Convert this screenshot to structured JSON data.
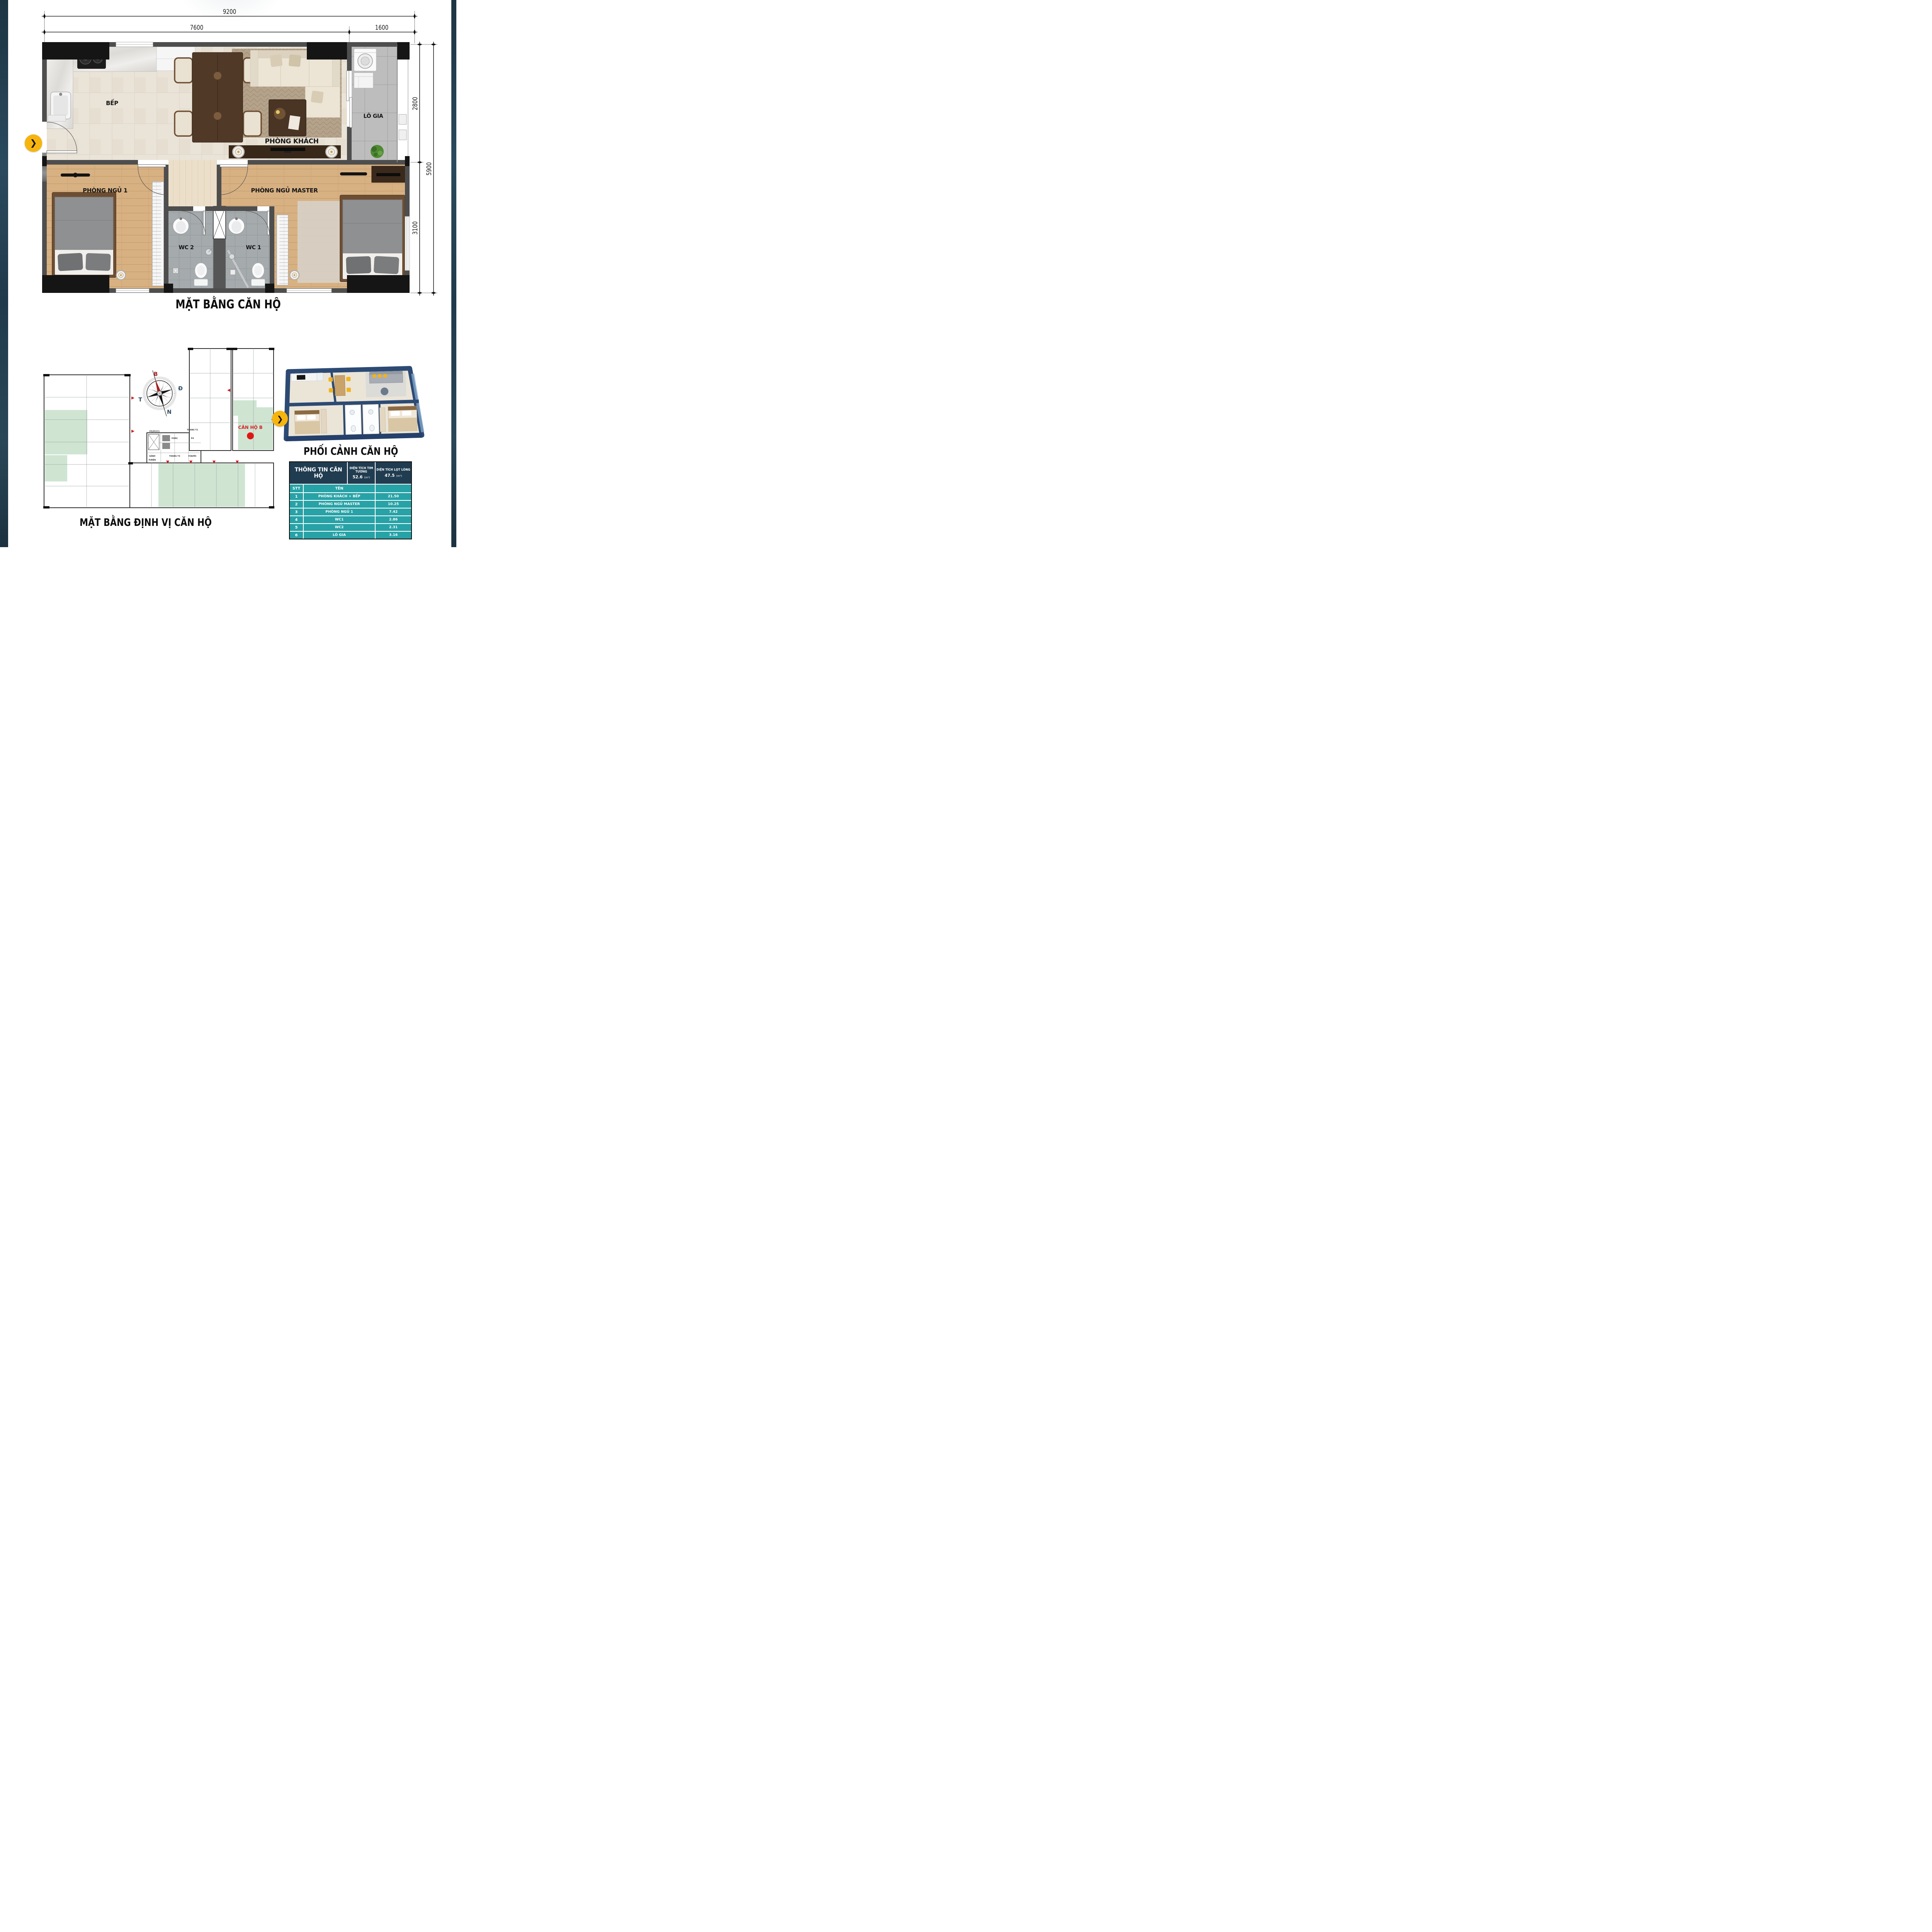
{
  "colors": {
    "accent_yellow": "#f6b40e",
    "table_header_bg": "#203c50",
    "table_row_bg": "#27a2a6",
    "highlight_green": "#cfe5d2",
    "red_marker": "#d81e1e",
    "wall_gray": "#4e4e4e",
    "band_navy": "#22394a"
  },
  "floor_plan": {
    "title": "MẶT BẰNG CĂN HỘ",
    "room_labels": {
      "kitchen": "BẾP",
      "living": "PHÒNG KHÁCH",
      "loggia": "LÔ GIA",
      "bedroom_1": "PHÒNG NGỦ 1",
      "bedroom_master": "PHÒNG NGỦ MASTER",
      "wc_1": "WC 1",
      "wc_2": "WC 2"
    },
    "dimensions": {
      "overall_width": "9200",
      "main_width": "7600",
      "loggia_width": "1600",
      "overall_depth": "5900",
      "living_depth": "2800",
      "bedroom_depth": "3100"
    }
  },
  "site_plan": {
    "title": "MẶT BẰNG ĐỊNH VỊ CĂN HỘ",
    "highlight_label": "CĂN HỘ B",
    "compass": {
      "north": "B",
      "east": "Đ",
      "south": "N",
      "west": "T"
    },
    "core_labels": [
      "THANG T2",
      "P5(PCCC)",
      "SẢNH",
      "P.RÁC",
      "P4",
      "P.ĐIỆN",
      "THANG T3",
      "P.NƯỚC"
    ]
  },
  "perspective": {
    "title": "PHỐI CẢNH CĂN HỘ"
  },
  "info_table": {
    "header": "THÔNG TIN CĂN HỘ",
    "area_columns": [
      {
        "title": "DIỆN TÍCH TIM TƯỜNG",
        "value": "52.6",
        "unit": "(m²)"
      },
      {
        "title": "DIỆN TÍCH LỌT LÒNG",
        "value": "47.5",
        "unit": "(m²)"
      }
    ],
    "sub_header": {
      "stt": "STT",
      "name": "TÊN"
    },
    "rows": [
      {
        "stt": "1",
        "name": "PHÒNG KHÁCH + BẾP",
        "area": "21.50"
      },
      {
        "stt": "2",
        "name": "PHÒNG NGỦ MASTER",
        "area": "10.25"
      },
      {
        "stt": "3",
        "name": "PHÒNG NGỦ 1",
        "area": "7.42"
      },
      {
        "stt": "4",
        "name": "WC1",
        "area": "2.86"
      },
      {
        "stt": "5",
        "name": "WC2",
        "area": "2.31"
      },
      {
        "stt": "6",
        "name": "LÔ GIA",
        "area": "3.16"
      }
    ]
  },
  "buttons": {
    "next_arrow": "❯"
  }
}
